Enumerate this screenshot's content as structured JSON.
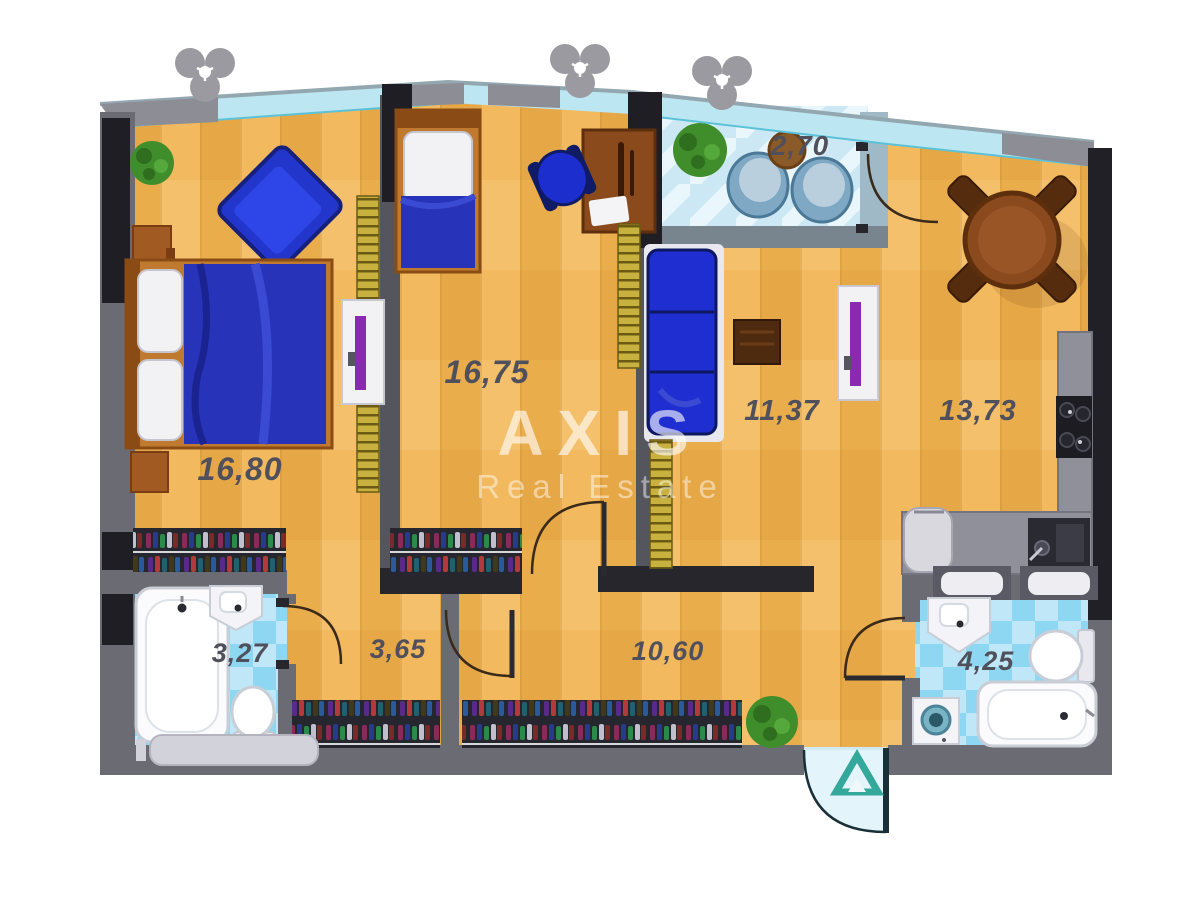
{
  "watermark": {
    "title": "AXIS",
    "subtitle": "Real Estate"
  },
  "rooms": [
    {
      "name": "bedroom",
      "area": "16,80"
    },
    {
      "name": "kids-room",
      "area": "16,75"
    },
    {
      "name": "living-area",
      "area": "11,37"
    },
    {
      "name": "kitchen-dining",
      "area": "13,73"
    },
    {
      "name": "balcony",
      "area": "2,70"
    },
    {
      "name": "bathroom-left",
      "area": "3,27"
    },
    {
      "name": "hall-small",
      "area": "3,65"
    },
    {
      "name": "hallway",
      "area": "10,60"
    },
    {
      "name": "bathroom-right",
      "area": "4,25"
    }
  ],
  "colors": {
    "wood_floor": "#f2b95e",
    "wood_floor_dark": "#eaad4c",
    "tile_light": "#bfe7f7",
    "tile_medium": "#8ed7f2",
    "wall_gray": "#6b6b73",
    "wall_dark": "#1e1e24",
    "window_cyan": "#bce7f2",
    "furniture_blue": "#2233cc",
    "wood_furniture": "#8a4a1e",
    "radiator_gold": "#c9b13f",
    "entry_arrow_teal": "#35a89c",
    "watermark_white": "#ffffff"
  }
}
